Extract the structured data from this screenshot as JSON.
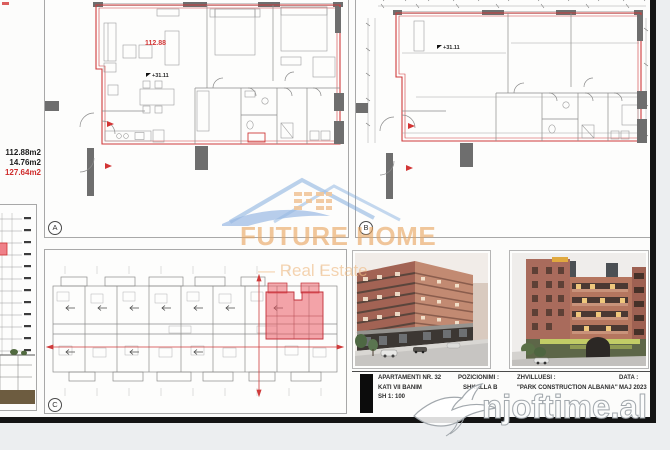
{
  "left_panel": {
    "areas": [
      {
        "value": "112.88m2",
        "red": false
      },
      {
        "value": "14.76m2",
        "red": false
      },
      {
        "value": "127.64m2",
        "red": true
      }
    ]
  },
  "plan_a": {
    "tag": "A",
    "area_label": "112.88",
    "elevation_label": "+31.11"
  },
  "plan_b": {
    "tag": "B",
    "elevation_label": "+31.11"
  },
  "plan_c": {
    "tag": "C"
  },
  "title_block": {
    "apartment_line1": "APARTAMENTI NR. 32",
    "apartment_line2": "KATI VII BANIM",
    "apartment_line3": "SH 1: 100",
    "position_label": "POZICIONIMI :",
    "position_value": "SHKALLA  B",
    "developer_label": "ZHVILLUESI :",
    "developer_value": "\"PARK CONSTRUCTION ALBANIA\"",
    "date_label": "DATA :",
    "date_value": "MAJ 2023"
  },
  "watermarks": {
    "brand_line1": "FUTURE HOME",
    "brand_line2": "Real Estate",
    "site": "njoftime.al"
  },
  "colors": {
    "accent_red": "#cf3b3b",
    "highlight_pink": "#ef5a62",
    "brand_orange": "#e9a55f",
    "brand_blue": "#5b8fd4",
    "wall_grey": "#6e6e6e"
  }
}
